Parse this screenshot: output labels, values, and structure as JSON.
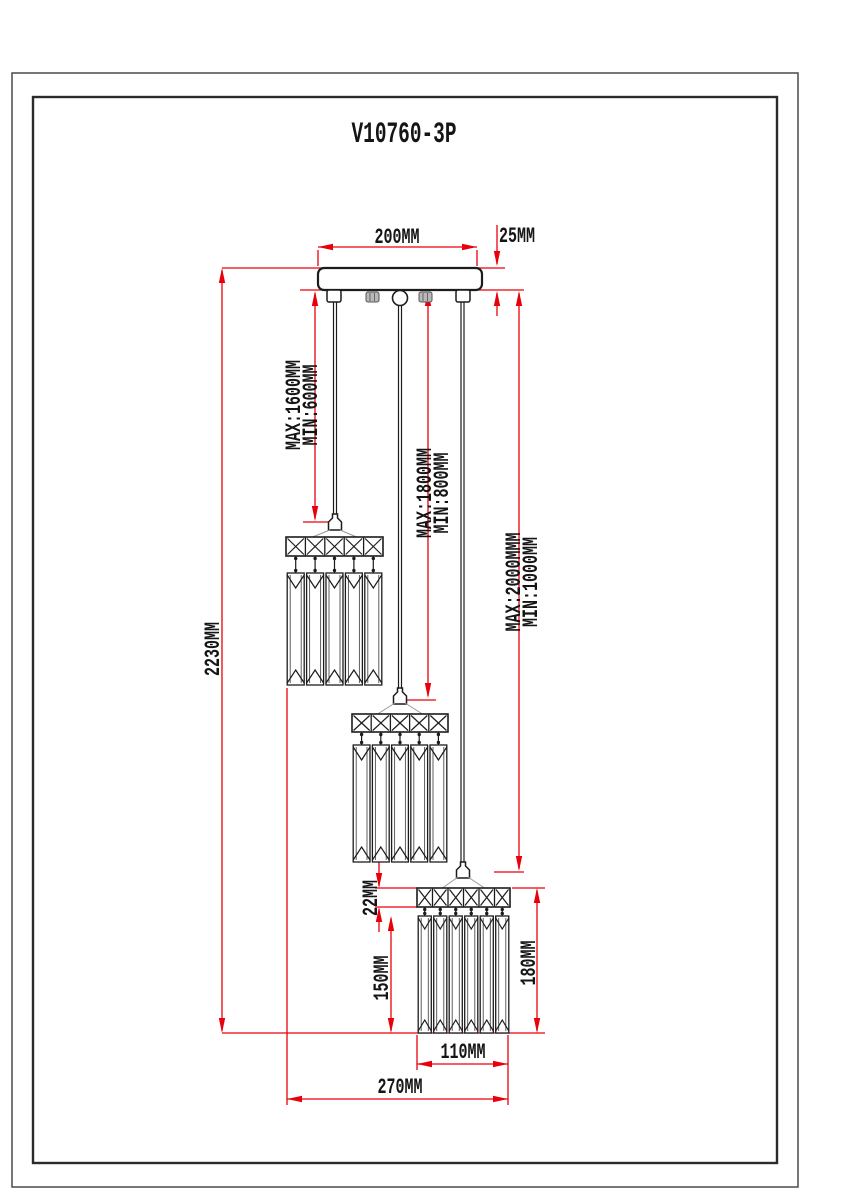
{
  "title": "V10760-3P",
  "drawing": {
    "canopy_width_label": "200MM",
    "canopy_height_label": "25MM",
    "overall_drop_label": "2230MM",
    "pendant1_max_label": "MAX:1600MM",
    "pendant1_min_label": "MIN:600MM",
    "pendant2_max_label": "MAX:1800MM",
    "pendant2_min_label": "MIN:800MM",
    "pendant3_max_label": "MAX:2000MMM",
    "pendant3_min_label": "MIN:1000MM",
    "band_height_label": "22MM",
    "prism_height_label": "150MM",
    "shade_height_label": "180MM",
    "shade_width_label": "110MM",
    "span_label": "270MM"
  },
  "colors": {
    "dimension_red": "#e8000a",
    "line_black": "#1c1c1c",
    "frame_gray": "#3a3a3a",
    "suspension_gray": "#999999"
  }
}
